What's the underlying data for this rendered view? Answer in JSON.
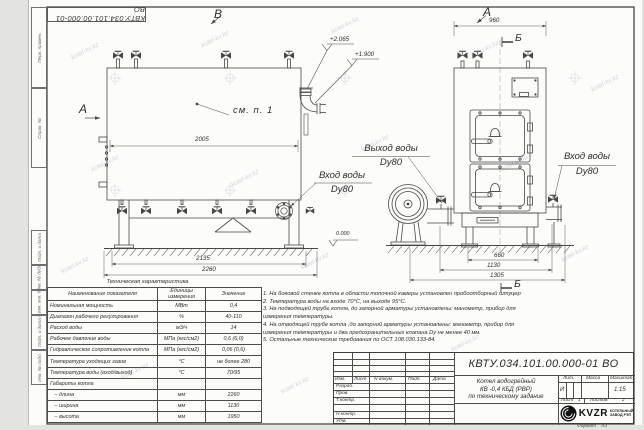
{
  "watermark": {
    "text": "kotel-kv.kz"
  },
  "top_stamp": {
    "doc_number_rotated": "КВТУ.034.101.00.000-01  ВО"
  },
  "side_stamp": {
    "box1": "Перв. примен.",
    "box2": "Справ. №",
    "box3": "Подп. и дата",
    "box4": "Инв. № дубл.",
    "box5": "Взам. инв. №",
    "box6": "Подп. и дата",
    "box7": "Инв. № подл."
  },
  "labels": {
    "view_b": "В",
    "view_a_arrow": "А",
    "view_a": "А",
    "section_b_top": "Б",
    "section_b_bottom": "Б",
    "see_item": "см. п. 1",
    "outlet_water": "Выход воды",
    "outlet_dn": "Dy80",
    "inlet_water_left": "Вход воды",
    "inlet_dn_left": "Dy80",
    "inlet_water_right": "Вход воды",
    "inlet_dn_right": "Dy80",
    "elevation_top": "+2.065",
    "elevation_mid": "+1.900",
    "elevation_zero": "0.000"
  },
  "dims": {
    "inner_width": "2005",
    "support_span": "2135",
    "total_length": "2260",
    "front_width": "960",
    "door_span": "660",
    "boiler_width": "1130",
    "overall_width": "1305"
  },
  "spec_table": {
    "title": "Техническая характеристика",
    "headers": [
      "Наименование показателя",
      "Единицы измерения",
      "Значение"
    ],
    "rows": [
      [
        "Номинальная мощность",
        "МВт",
        "0,4"
      ],
      [
        "Диапазон рабочего регулирования",
        "%",
        "40-110"
      ],
      [
        "Расход воды",
        "м3/ч",
        "14"
      ],
      [
        "Рабочее давление воды",
        "МПа (кгс/см2)",
        "0,6 (6,0)"
      ],
      [
        "Гидравлическое сопротивление котла",
        "МПа (кгс/см2)",
        "0,06 (0,6)"
      ],
      [
        "Температура уходящих газов",
        "°С",
        "не более 280"
      ],
      [
        "Температура воды (вход/выход)",
        "°С",
        "70/95"
      ],
      [
        "Габариты котла",
        "",
        ""
      ],
      [
        "   – длина",
        "мм",
        "2260"
      ],
      [
        "   – ширина",
        "мм",
        "1130"
      ],
      [
        "   – высота",
        "мм",
        "1950"
      ]
    ]
  },
  "notes": {
    "lines": [
      "1.  На боковой стенке котла в области топочной камеры установлен пробоотборный штуцер",
      "2.  Температура воды на входе  70°С, на выходе  95°С.",
      "3.  На подводящей трубе котла, до запорной арматуры установлены:  манометр, прибор для",
      "измерения температуры.",
      "4.  На отводящей трубе котла ,до запорной арматуры установлены:  манометр, прибор для",
      "измерения температуры и два предохранительных клапана  Dy не менее  40 мм.",
      "5.  Остальные технические требования по ОСТ  108.030.133-84."
    ]
  },
  "title_block": {
    "doc_number": "КВТУ.034.101.00.000-01  ВО",
    "title_line1": "Котел водогрейный",
    "title_line2": "КВ -0,4   КБД   (РВР)",
    "title_line3": "по техническому задание",
    "header_cells": [
      "Изм.",
      "Лист",
      "N докум.",
      "Подп.",
      "Дата"
    ],
    "sign_rows": [
      "Разраб.",
      "Пров.",
      "Т.контр.",
      "",
      "Н.контр.",
      "Утв."
    ],
    "lit_label": "Лит.",
    "mass_label": "Масса",
    "scale_label": "Масштаб",
    "lit_value": "И",
    "scale_value": "1:15",
    "sheet_label": "Лист",
    "sheet_value": "1",
    "sheets_label": "Листов",
    "sheets_value": "2",
    "company": "KVZR",
    "company_sub1": "КОТЕЛЬНЫЙ",
    "company_sub2": "ЗАВОД РЭП",
    "format_label": "Формат",
    "format_value": "А3"
  }
}
